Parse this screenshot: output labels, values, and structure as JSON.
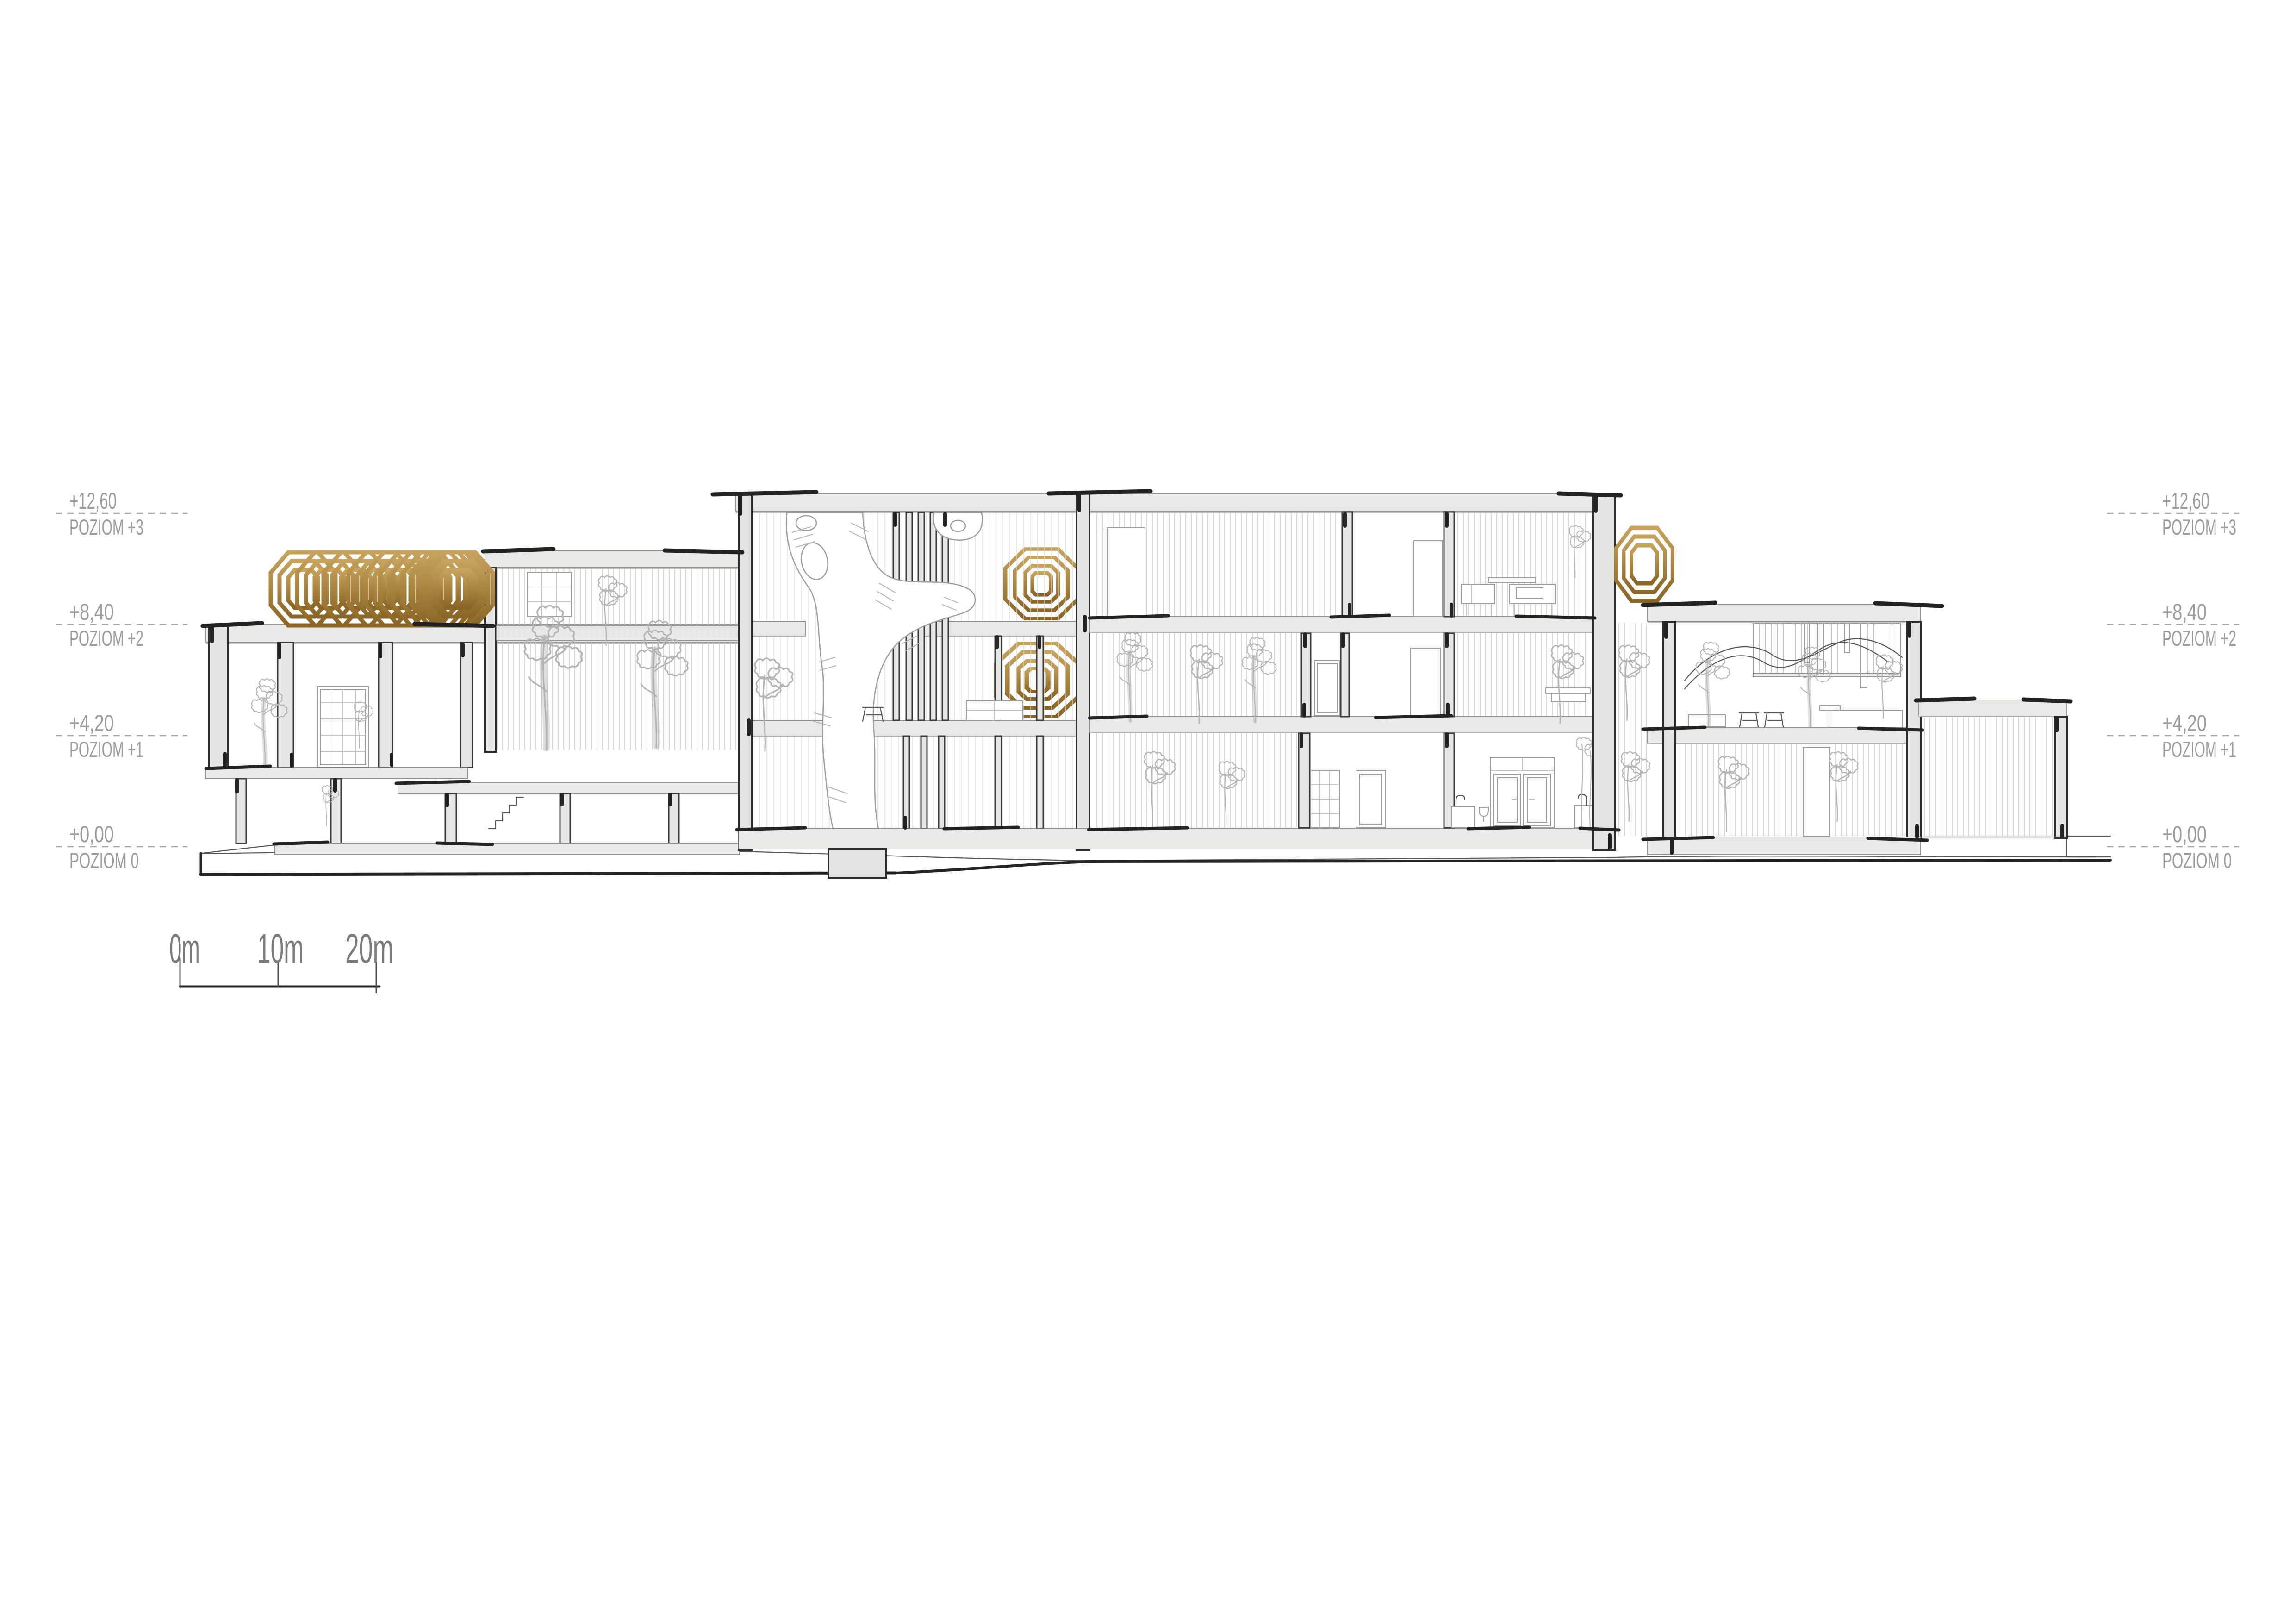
{
  "document": {
    "kind": "architectural cross-section sketch",
    "language": "Polish",
    "background": "#ffffff"
  },
  "levels": [
    {
      "elevation": "+12,60",
      "label": "POZIOM +3"
    },
    {
      "elevation": "+8,40",
      "label": "POZIOM +2"
    },
    {
      "elevation": "+4,20",
      "label": "POZIOM +1"
    },
    {
      "elevation": "+0,00",
      "label": "POZIOM 0"
    }
  ],
  "scale_bar": {
    "ticks": [
      "0m",
      "10m",
      "20m"
    ]
  },
  "palette": {
    "gold_light": "#c4a058",
    "gold_dark": "#8d6826",
    "slab_fill": "#e9e9e8",
    "ink": "#232323",
    "hatch_line": "#c9c9c9",
    "vegetation": "#b4b4b8",
    "level_text": "#9c9c9c",
    "scale_text": "#7b7b7b"
  }
}
